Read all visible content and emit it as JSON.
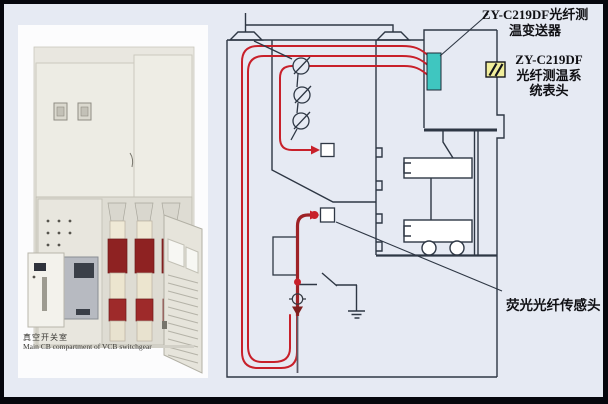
{
  "page": {
    "background": "#e6eaf3",
    "frame_color": "#06070d"
  },
  "photo": {
    "caption_zh": "真空开关室",
    "caption_en": "Main CB compartment of VCB switchgear"
  },
  "diagram": {
    "labels": {
      "transmitter_line1": "ZY-C219DF光纤测",
      "transmitter_line2": "温变送器",
      "meter_line1": "ZY-C219DF",
      "meter_line2": "光纤测温系",
      "meter_line3": "统表头",
      "sensor": "荧光光纤传感头"
    },
    "colors": {
      "fiber_cable": "#c8202a",
      "fiber_cable_dark": "#9e2226",
      "transmitter_fill": "#3fc6c0",
      "meter_fill": "#f1ee9b",
      "line": "#2e3744"
    }
  }
}
